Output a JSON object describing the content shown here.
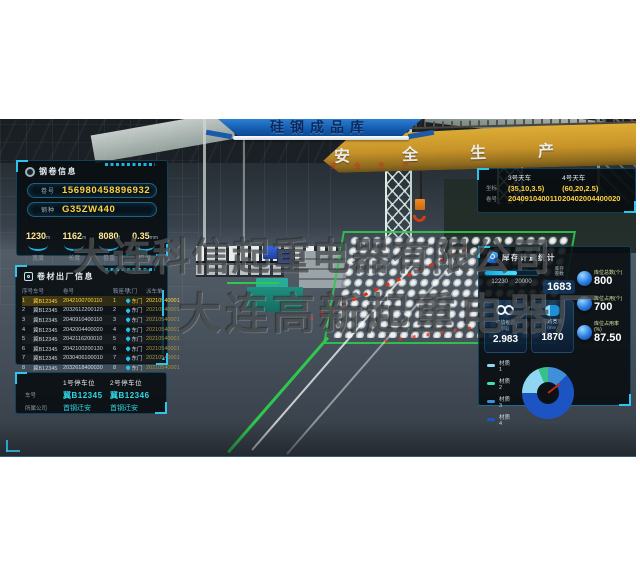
{
  "banner": {
    "title": "硅钢成品库"
  },
  "watermark": {
    "line1": "大连科信起重电器有限公司",
    "line2": "大连高新起重电器厂"
  },
  "scene3d": {
    "girder_text": "安全生产",
    "girder_text_red": "安全生产"
  },
  "coil_info": {
    "title": "钢卷信息",
    "fields": [
      {
        "label": "卷号",
        "value": "156980458896932"
      },
      {
        "label": "钢种",
        "value": "G35ZW440"
      }
    ],
    "stats": [
      {
        "value": "1230",
        "unit": "m",
        "label": "宽度"
      },
      {
        "value": "1162",
        "unit": "m",
        "label": "长度"
      },
      {
        "value": "8080",
        "unit": "t",
        "label": "卷重"
      },
      {
        "value": "0.35",
        "unit": "mm",
        "label": "厚度"
      }
    ]
  },
  "shipping": {
    "title": "卷材出厂信息",
    "columns": [
      "序号",
      "车号",
      "卷号",
      "鞍座号",
      "大门",
      "派车单"
    ],
    "rows": [
      {
        "seq": "1",
        "truck": "冀B12345",
        "coil": "2042100700110",
        "saddle": "1",
        "gate": "东门",
        "order": "20210540001",
        "highlight": true
      },
      {
        "seq": "2",
        "truck": "冀B12345",
        "coil": "2032612200120",
        "saddle": "2",
        "gate": "东门",
        "order": "20210540001"
      },
      {
        "seq": "3",
        "truck": "冀B12345",
        "coil": "2040910400110",
        "saddle": "3",
        "gate": "东门",
        "order": "20210540001"
      },
      {
        "seq": "4",
        "truck": "冀B12345",
        "coil": "2042004400020",
        "saddle": "4",
        "gate": "东门",
        "order": "20210540001"
      },
      {
        "seq": "5",
        "truck": "冀B12345",
        "coil": "2042116200010",
        "saddle": "5",
        "gate": "东门",
        "order": "20210540001"
      },
      {
        "seq": "6",
        "truck": "冀B12345",
        "coil": "2042100200130",
        "saddle": "6",
        "gate": "东门",
        "order": "20210540001"
      },
      {
        "seq": "7",
        "truck": "冀B12345",
        "coil": "2030406100010",
        "saddle": "7",
        "gate": "东门",
        "order": "20210540001"
      },
      {
        "seq": "8",
        "truck": "冀B12345",
        "coil": "2032618400030",
        "saddle": "8",
        "gate": "东门",
        "order": "20210540001"
      }
    ]
  },
  "parking": {
    "labels": {
      "plate": "车号",
      "company": "所属公司"
    },
    "spots": [
      {
        "title": "1号停车位",
        "plate": "冀B12345",
        "company": "首钢迁安"
      },
      {
        "title": "2号停车位",
        "plate": "冀B12346",
        "company": "首钢迁安"
      }
    ]
  },
  "cranes": {
    "labels": {
      "coord": "坐标",
      "coil": "卷号"
    },
    "items": [
      {
        "name": "3号天车",
        "coord": "(35,10,3.5)",
        "coil": "2040910400110"
      },
      {
        "name": "4号天车",
        "coord": "(60,20,2.5)",
        "coil": "20402004400020"
      }
    ]
  },
  "stats": {
    "title": "库存计量统计",
    "inventory": {
      "current": 12230,
      "max": 20000,
      "current_text": "12230",
      "max_text": "20000",
      "label_line1": "库存",
      "label_line2": "卷数",
      "value": "1683"
    },
    "cards": [
      {
        "label": "平均卷重",
        "unit": "(吨)",
        "value": "2.983"
      },
      {
        "label": "平均宽度",
        "unit": "(mm)",
        "value": "1870"
      }
    ],
    "kpis": [
      {
        "label": "库位总数(个)",
        "value": "800"
      },
      {
        "label": "库位占用(个)",
        "value": "700"
      },
      {
        "label": "库位占用率(%)",
        "value": "87.50"
      }
    ],
    "legend": [
      {
        "label": "材质1",
        "color": "#8fd6f2"
      },
      {
        "label": "材质2",
        "color": "#44e0a8"
      },
      {
        "label": "材质3",
        "color": "#3f8fd9"
      },
      {
        "label": "材质4",
        "color": "#1d54c4"
      }
    ],
    "chart_data": {
      "type": "pie",
      "title": "材质占比",
      "categories": [
        "材质2",
        "材质3",
        "材质4",
        "材质1"
      ],
      "values": [
        6,
        13,
        62,
        19
      ],
      "donut": {
        "from_deg": -22,
        "segments": [
          {
            "name": "材质2",
            "color": "#37c08a",
            "pct": 6
          },
          {
            "name": "材质3",
            "color": "#3f8fd9",
            "pct": 13
          },
          {
            "name": "材质4",
            "color": "#1d54c4",
            "pct": 62
          },
          {
            "name": "材质1",
            "color": "#8fd6f2",
            "pct": 19
          }
        ]
      }
    }
  }
}
